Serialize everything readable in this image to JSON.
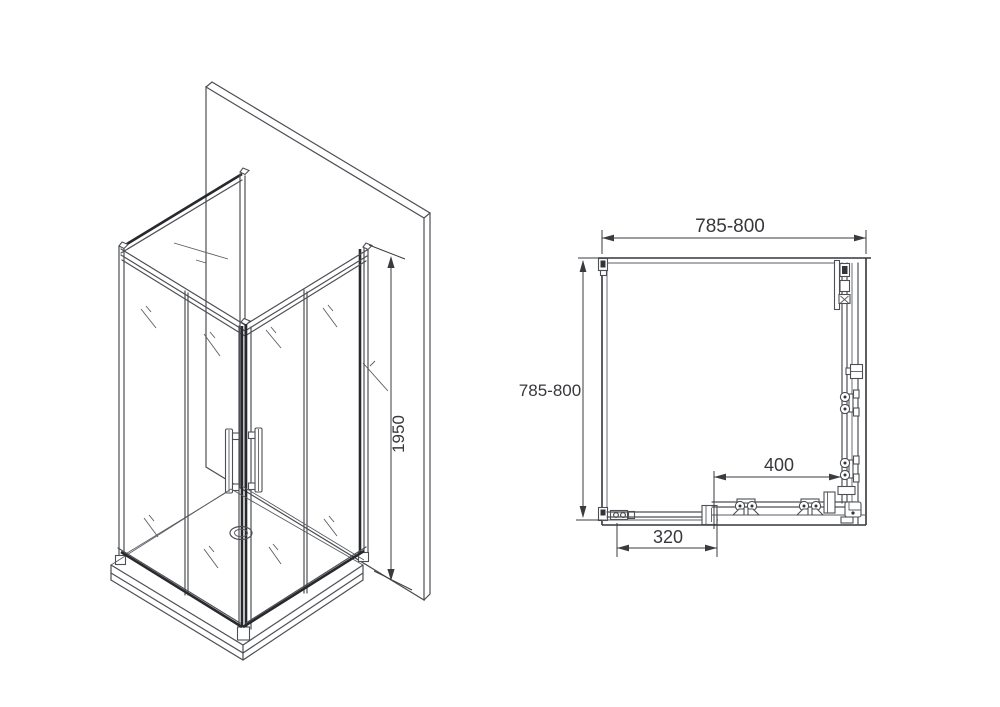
{
  "colors": {
    "line": "#4d4f54",
    "dark_line": "#28292d",
    "dimension": "#37383c",
    "background": "#ffffff"
  },
  "isometric_view": {
    "height_dimension_label": "1950"
  },
  "plan_view": {
    "top_width_label": "785-800",
    "left_depth_label": "785-800",
    "door_opening_label": "400",
    "fixed_panel_label": "320"
  }
}
